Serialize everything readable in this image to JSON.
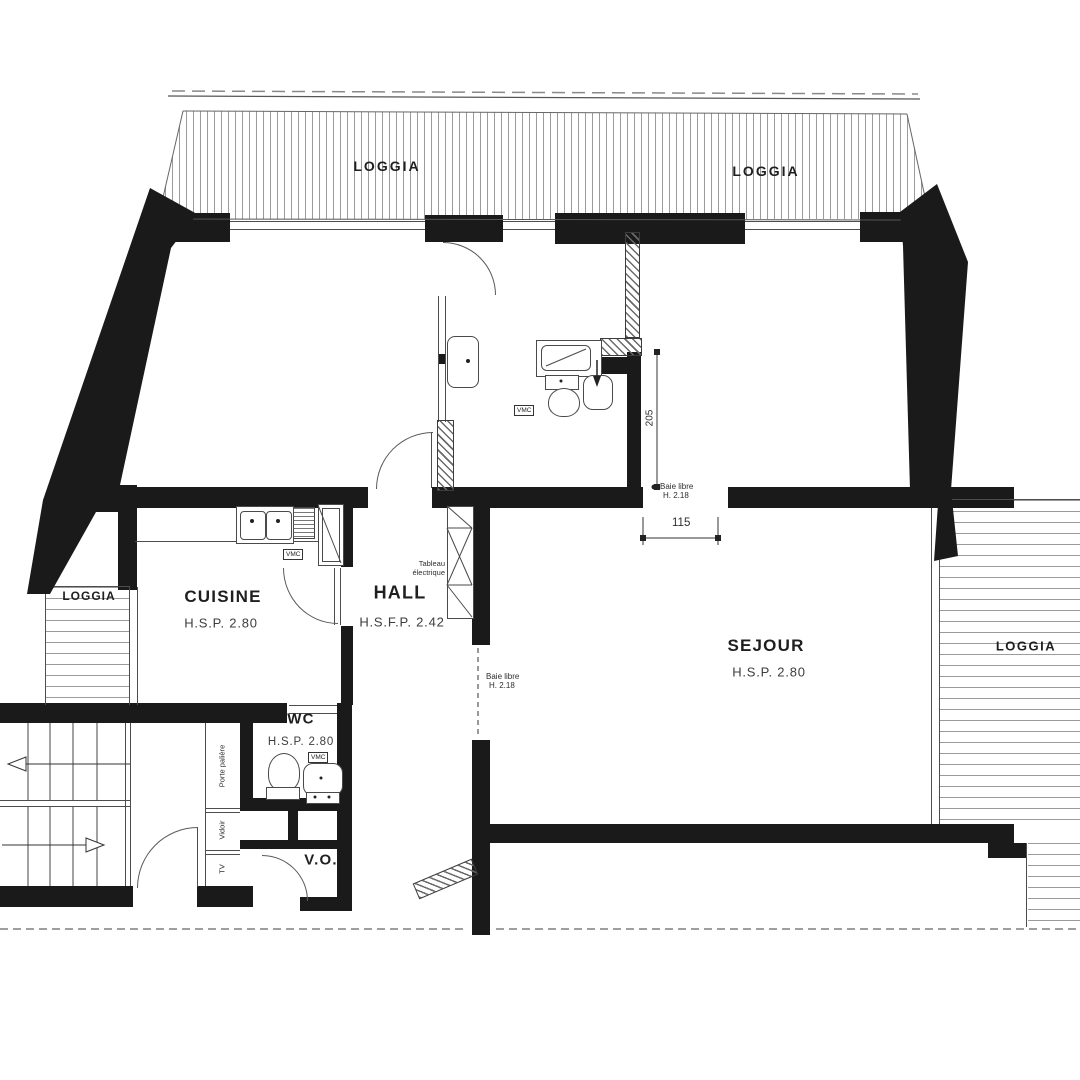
{
  "rooms": {
    "loggia_top_left": {
      "label": "LOGGIA"
    },
    "loggia_top_right": {
      "label": "LOGGIA"
    },
    "loggia_left": {
      "label": "LOGGIA"
    },
    "loggia_right": {
      "label": "LOGGIA"
    },
    "cuisine": {
      "label": "CUISINE",
      "ceiling": "H.S.P. 2.80"
    },
    "hall": {
      "label": "HALL",
      "ceiling": "H.S.F.P. 2.42"
    },
    "sejour": {
      "label": "SEJOUR",
      "ceiling": "H.S.P. 2.80"
    },
    "wc": {
      "label": "WC",
      "ceiling": "H.S.P. 2.80"
    },
    "vide_ordures": {
      "label": "V.O."
    }
  },
  "annotations": {
    "tableau_line1": "Tableau",
    "tableau_line2": "électrique",
    "baie_libre": "Baie libre",
    "baie_height": "H. 2.18",
    "vmc": "VMC",
    "porte_paliere": "Porte palière",
    "vidoir": "Vidoir",
    "tv": "TV"
  },
  "dimensions": {
    "bay_width": "115",
    "wall_length": "205"
  },
  "colors": {
    "wall": "#1a1a1a",
    "line": "#4d4d4d",
    "hatch": "#9b9b9b",
    "text": "#1f1f1f",
    "subtext": "#3d3d3d"
  }
}
